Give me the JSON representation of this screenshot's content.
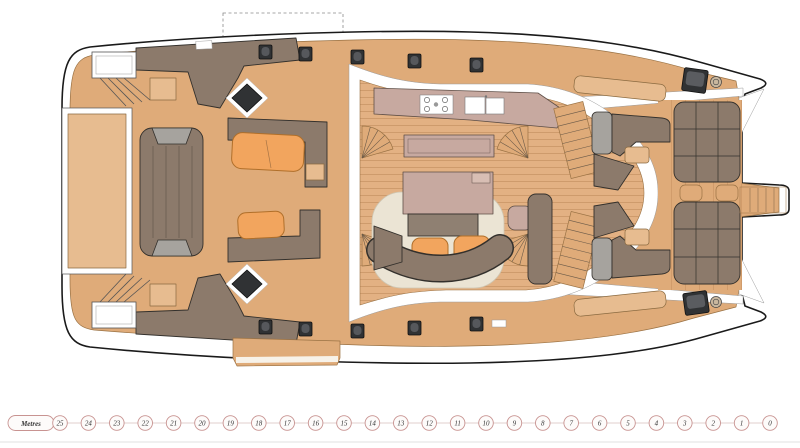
{
  "scale": {
    "label": "Metres",
    "unit_ticks": [
      "25",
      "24",
      "23",
      "22",
      "21",
      "20",
      "19",
      "18",
      "17",
      "16",
      "15",
      "14",
      "13",
      "12",
      "11",
      "10",
      "9",
      "8",
      "7",
      "6",
      "5",
      "4",
      "3",
      "2",
      "1",
      "0"
    ]
  },
  "palette": {
    "deck": "#dfab79",
    "panel": "#e7bc90",
    "floor": "#e3b183",
    "furniture": "#8c7a6b",
    "furniture_dark": "#33302c",
    "orange": "#f2a55e",
    "cream": "#ebe4d4",
    "counter": "#c7a9a0",
    "gray": "#a6a39e",
    "hatch_dark": "#303234",
    "outline": "#1a1a1a",
    "scale_ring": "#c89391"
  }
}
